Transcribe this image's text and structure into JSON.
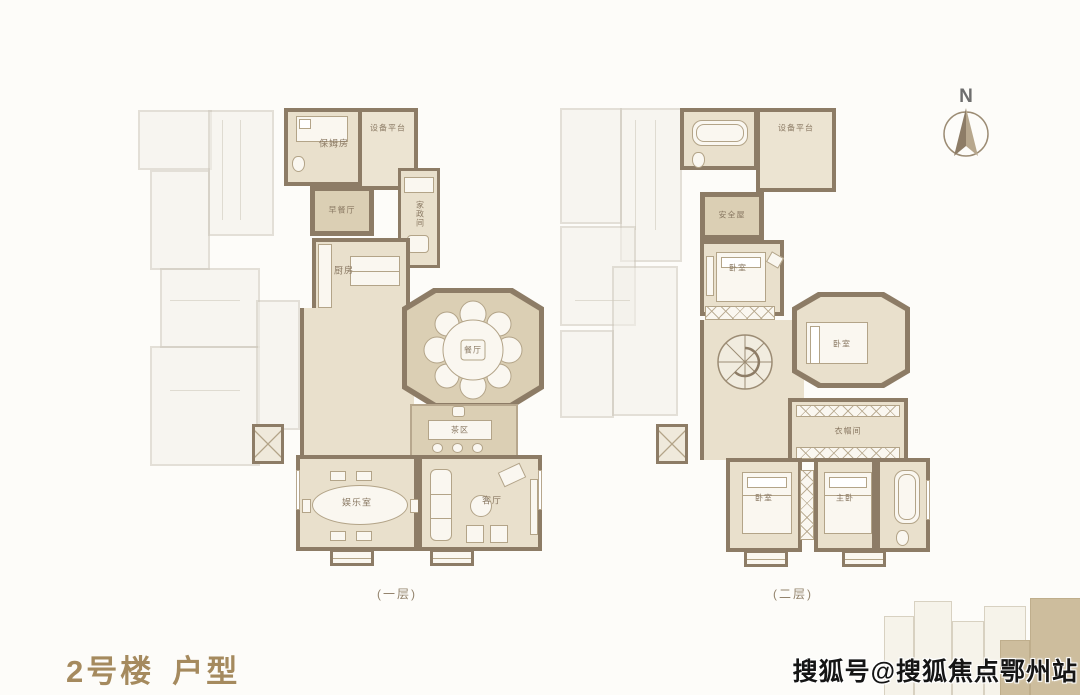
{
  "title": {
    "building": "2号楼",
    "unit": "户型"
  },
  "compass": {
    "label": "N"
  },
  "watermark": {
    "text": "搜狐号@搜狐焦点鄂州站"
  },
  "floor1": {
    "caption": "(一层)",
    "rooms": {
      "nanny": "保姆房",
      "equipment": "设备平台",
      "breakfast": "早餐厅",
      "housekeeping": "家政间",
      "kitchen": "厨房",
      "dining": "餐厅",
      "tea": "茶区",
      "entertainment": "娱乐室",
      "living": "客厅"
    }
  },
  "floor2": {
    "caption": "(二层)",
    "rooms": {
      "equipment": "设备平台",
      "safe": "安全屋",
      "bedroom1": "卧室",
      "bedroom2": "卧室",
      "closet": "衣帽间",
      "bedroom3": "卧室",
      "master": "主卧"
    }
  },
  "colors": {
    "accent": "#a58a5e",
    "wall": "#8d7c66",
    "floor": "#e9e0cc"
  }
}
